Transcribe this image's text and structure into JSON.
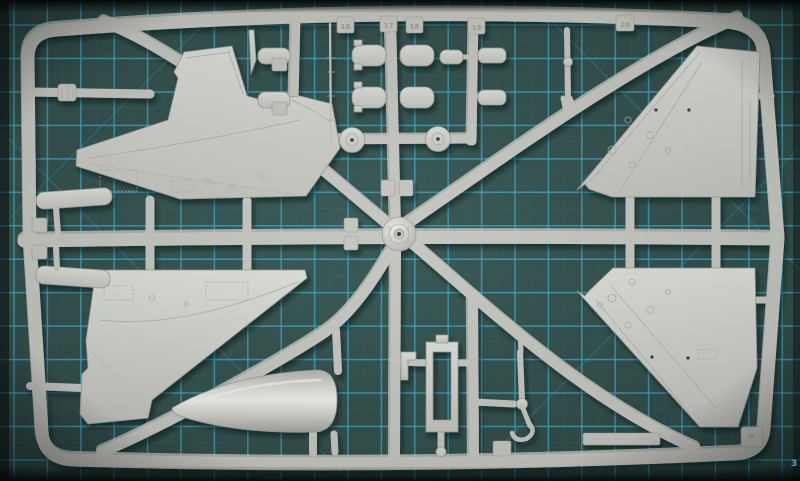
{
  "scene": {
    "description": "Photograph of a light gray injection-molded model aircraft sprue lying on a teal cutting mat with cyan grid lines",
    "object": "plastic model kit sprue",
    "surface": "self-healing cutting mat"
  },
  "colors": {
    "mat_base": "#2e4b48",
    "mat_mottle": "#5a8c85",
    "mat_edge": "#0d1413",
    "grid_major": "#3aa6c6",
    "grid_minor": "#2f7f99",
    "plastic": "#c7c8c2",
    "plastic_light": "#eaece6",
    "plastic_dark": "#9b9d97",
    "part_fill": "#d3d4cf",
    "part_line": "#aeafa9",
    "hole_dark": "#3a3f3c",
    "shadow": "#061010"
  },
  "sprue": {
    "tags": {
      "t16": "16",
      "t17": "17",
      "t18": "18",
      "t19": "19",
      "t20": "20",
      "corner": "C"
    }
  },
  "mat": {
    "edge_mark": "3"
  }
}
